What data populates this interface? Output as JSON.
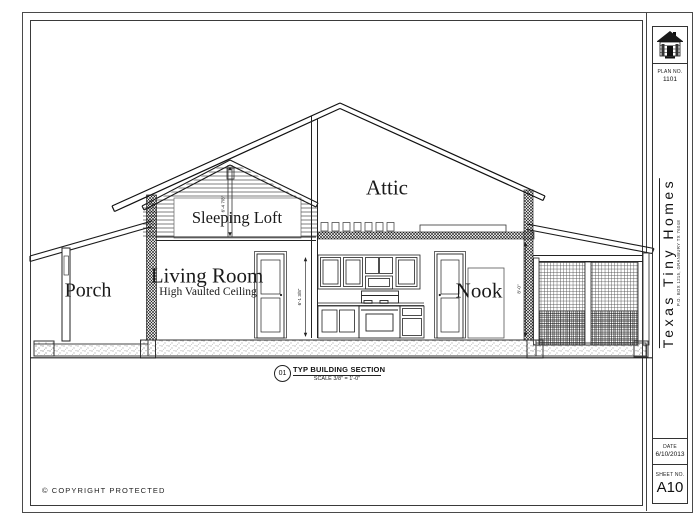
{
  "page": {
    "copyright": "© COPYRIGHT PROTECTED"
  },
  "colors": {
    "line": "#2a2a2a",
    "paper": "#ffffff"
  },
  "title_block": {
    "plan_label": "PLAN NO.",
    "plan_number": "1101",
    "company_name": "Texas Tiny Homes",
    "company_address": "P.O. BOX 1215, GRANBURY TX 76048",
    "date_label": "DATE",
    "date_value": "6/10/2013",
    "sheet_label": "SHEET NO.",
    "sheet_number": "A10"
  },
  "drawing": {
    "labels": {
      "porch": "Porch",
      "living_room": "Living Room",
      "living_room_sub": "High Vaulted Ceiling",
      "sleeping_loft": "Sleeping Loft",
      "attic": "Attic",
      "nook": "Nook"
    },
    "dimensions": {
      "loft_height": "6'-4 7/8\"",
      "wall_height": "6'-1 3/8\"",
      "nook_height": "8'-0\""
    },
    "section_callout": {
      "number": "01",
      "title": "TYP BUILDING SECTION",
      "scale": "SCALE 3/8\" = 1'-0\""
    }
  }
}
